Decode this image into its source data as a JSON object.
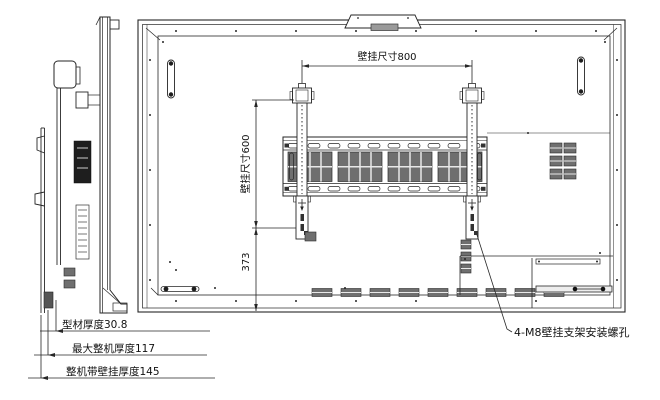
{
  "drawing": {
    "dimensions": {
      "wall_mount_width": "壁挂尺寸800",
      "wall_mount_height": "壁挂尺寸600",
      "bottom_offset": "373",
      "profile_thickness": "型材厚度30.8",
      "max_unit_thickness": "最大整机厚度117",
      "unit_with_mount_thickness": "整机带壁挂厚度145"
    },
    "annotations": {
      "mount_hole_note": "4-M8壁挂支架安装螺孔"
    },
    "colors": {
      "line": "#262626",
      "background": "#ffffff",
      "vent_fill": "#6f6f6f",
      "label_dark": "#1e1e1e",
      "camera_window": "#9a9a9a"
    }
  }
}
